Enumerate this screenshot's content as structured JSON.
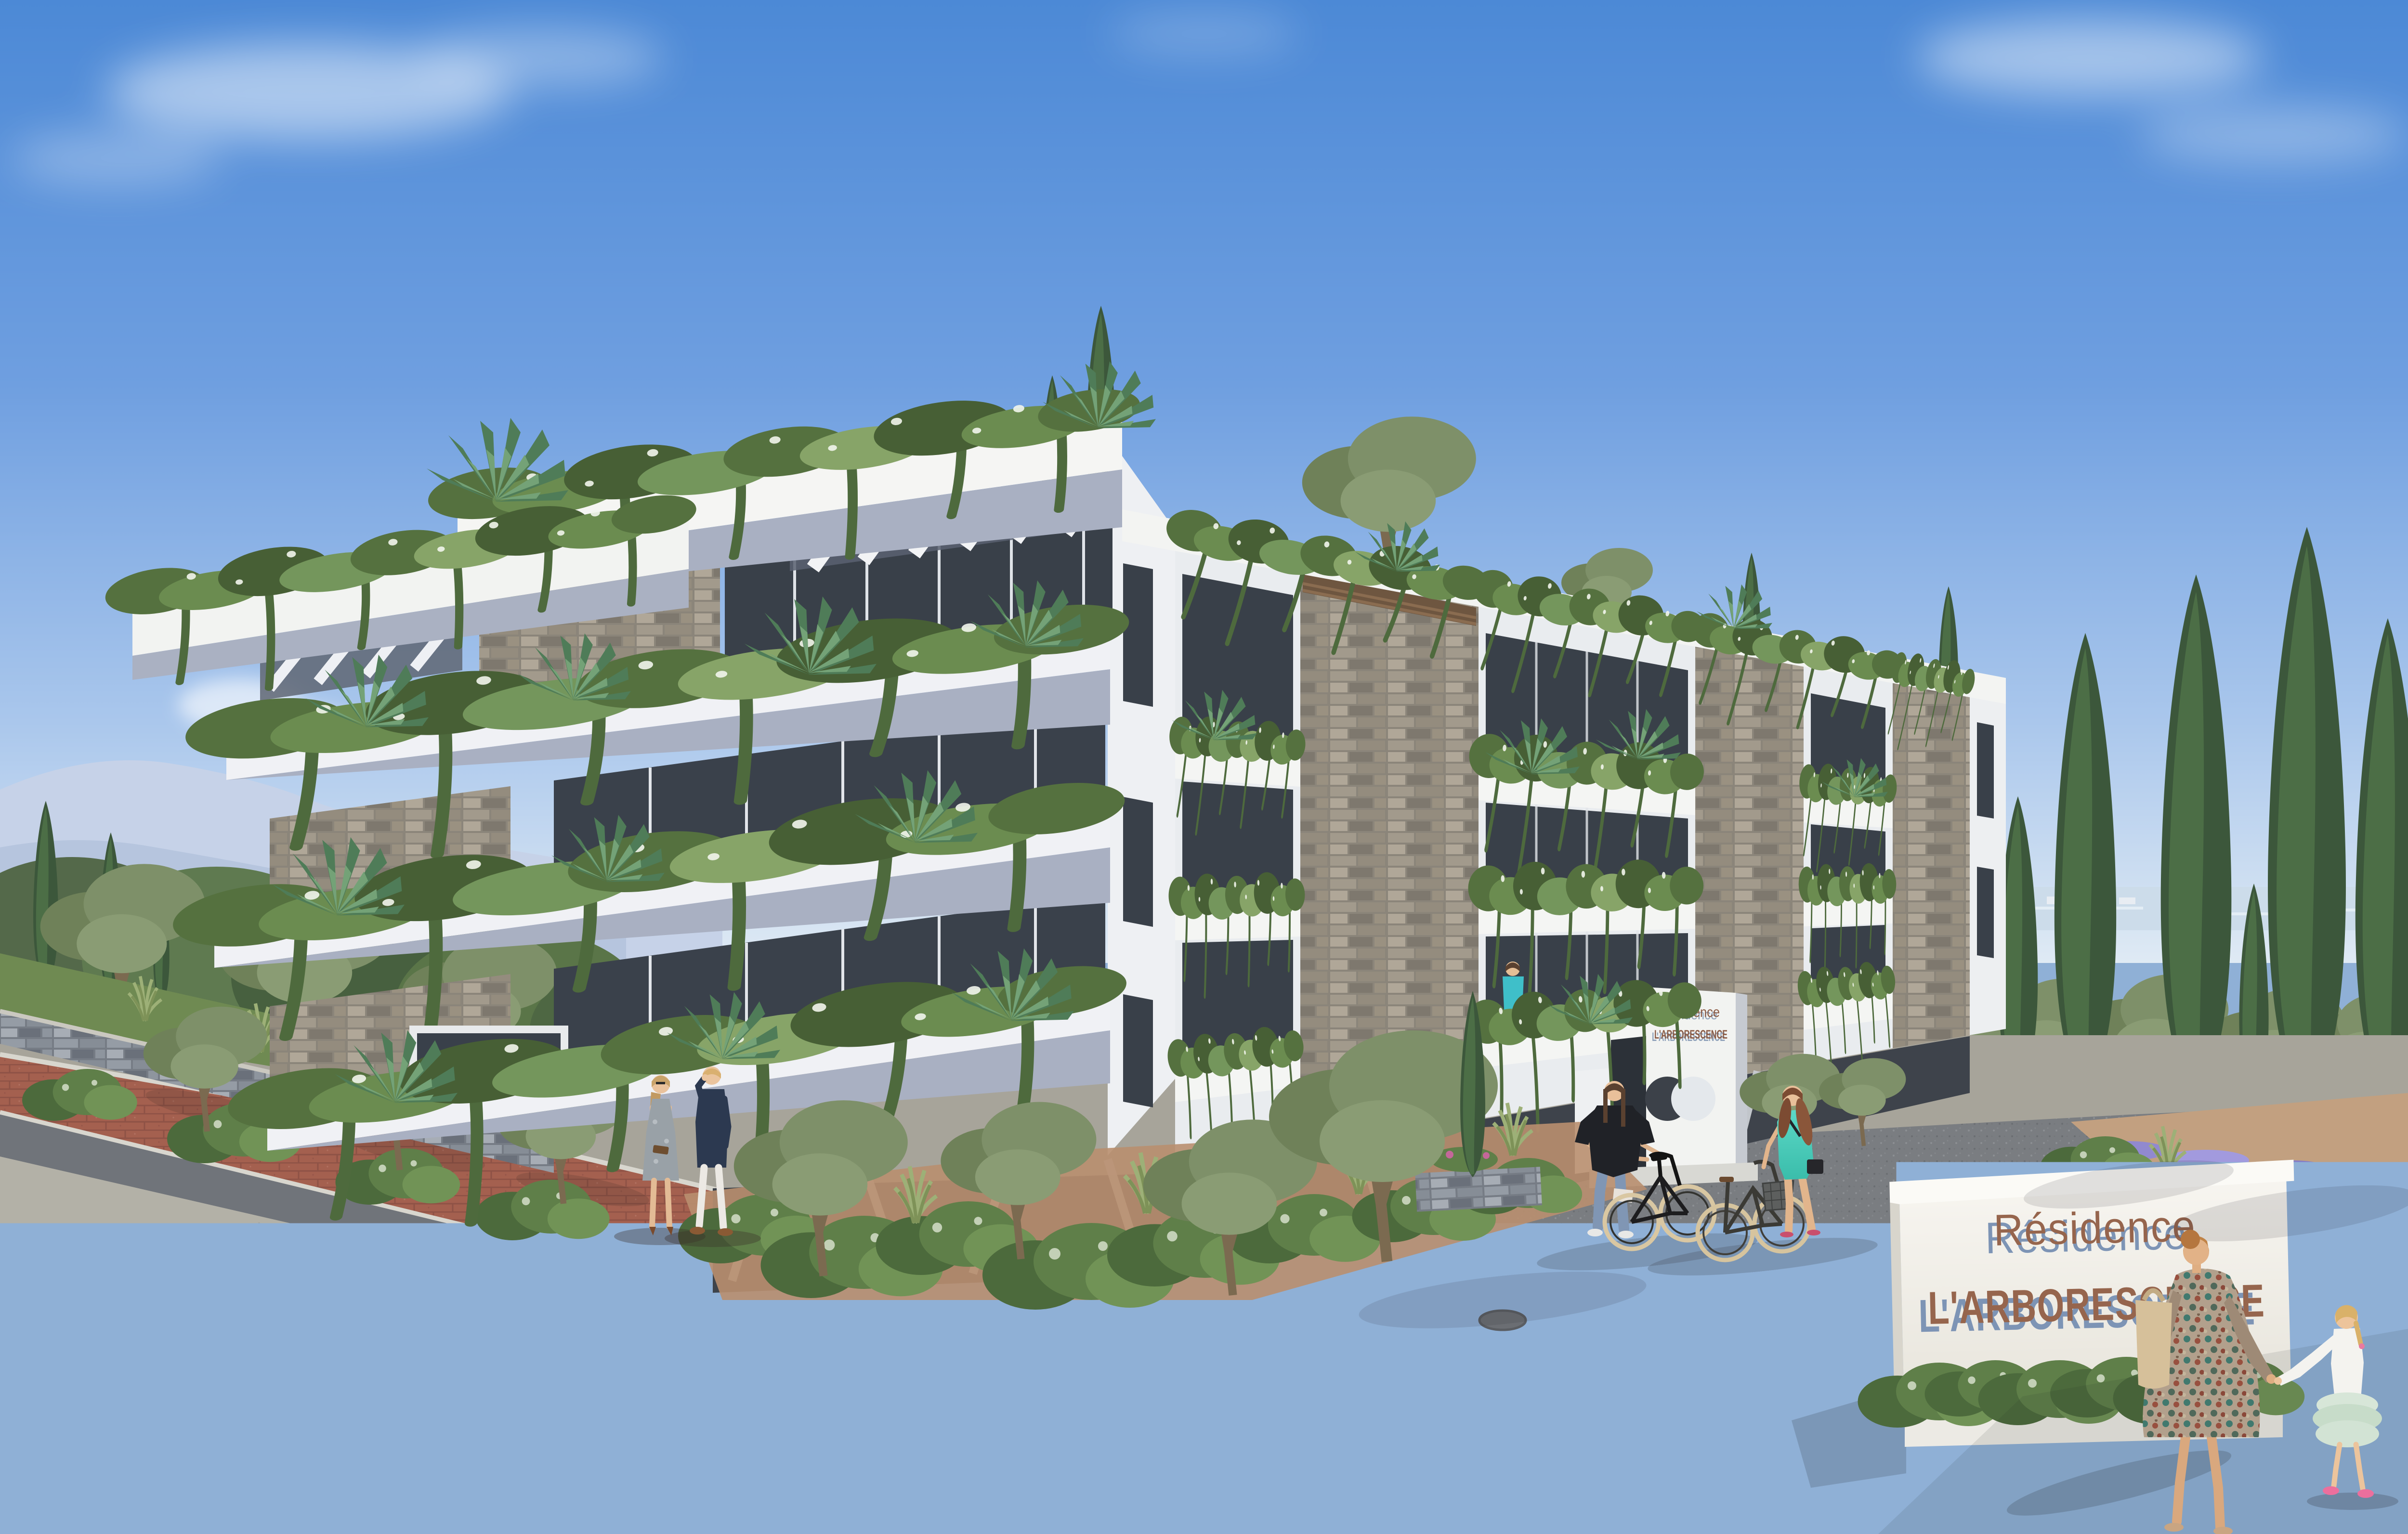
{
  "scene": {
    "type": "architectural-rendering",
    "setting": "Modern Mediterranean apartment building with plant-covered cantilevered balconies, street, entry plaza, pedestrians and cyclists",
    "time_of_day": "sunny daytime"
  },
  "monument_sign": {
    "line1": "Résidence",
    "line2": "L'ARBORESCENCE"
  },
  "entrance_sign": {
    "line1": "Résidence",
    "line2": "L'ARBORESCENCE"
  },
  "building": {
    "floors_visible": 4,
    "features": [
      "cantilevered white balcony slabs",
      "cascading balcony planting with white flowers",
      "dry-stone clad pillars",
      "roof pergola slats",
      "slanted pilotis over dark recessed base",
      "rooftop cypress and olive trees"
    ]
  },
  "people": [
    {
      "label": "couple talking on red path"
    },
    {
      "label": "woman in black top walking a black bicycle"
    },
    {
      "label": "woman in turquoise dress walking a bicycle with basket"
    },
    {
      "label": "mother in patterned dress with beige tote bag"
    },
    {
      "label": "girl in white top and mint tutu skirt"
    },
    {
      "label": "couple standing on second floor balcony"
    },
    {
      "label": "man in turquoise shirt on upper balcony"
    }
  ],
  "vegetation": [
    "italian cypress trees",
    "olive trees",
    "lavender beds",
    "hanging balcony garlands",
    "agave and yucca plants",
    "clipped shrubs",
    "ornamental grasses"
  ],
  "palette": {
    "sky_top": "#4c89d6",
    "sky_horizon": "#dfeaf4",
    "mountains": "#c6d2e8",
    "sea": "#ccdcea",
    "building_white": "#f3f4f2",
    "slab_shadow": "#a9b0c2",
    "stone_warm": "#8b857a",
    "stone_cool": "#767c85",
    "base_dark": "#3e434b",
    "window_dark": "#394049",
    "foliage_dark": "#475f35",
    "foliage_light": "#74965c",
    "cypress": "#3c573b",
    "lavender": "#9189cf",
    "red_path": "#a4604f",
    "plaza": "#7a7d81",
    "sidewalk": "#b3b1a7",
    "grass": "#7c9c57",
    "sign_text": "#96654d",
    "sign_text_shadow": "#7d94b5"
  }
}
